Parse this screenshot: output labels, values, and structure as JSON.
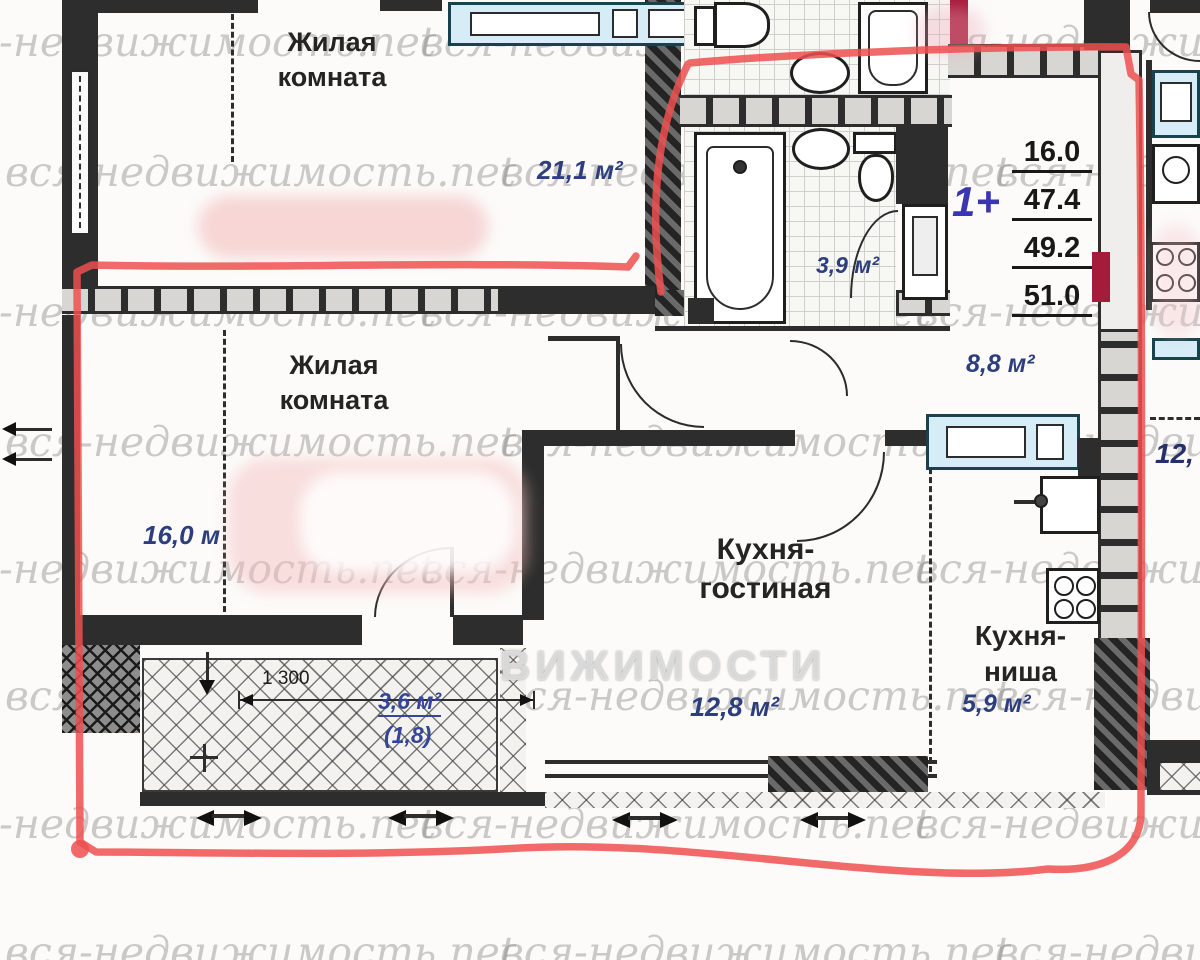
{
  "plan": {
    "watermark_text": "вся-недвижимость.net",
    "watermark_big_partial": "ВИЖИМОСТИ",
    "rooms": {
      "living1": {
        "name": "Жилая комната",
        "area": "21,1 м²"
      },
      "living2": {
        "name": "Жилая комната",
        "area": "16,0 м"
      },
      "bathroom": {
        "area": "3,9 м²"
      },
      "hallway": {
        "area": "8,8 м²"
      },
      "kitchen_living": {
        "name": "Кухня-гостиная",
        "area": "12,8 м²"
      },
      "kitchen_niche": {
        "name": "Кухня-ниша",
        "area": "5,9 м²"
      },
      "balcony": {
        "area": "3,6 м²",
        "area_reduced": "(1,8)"
      },
      "neighbor_partial_area": "12,"
    },
    "summary": {
      "type_label": "1+",
      "areas": [
        "16.0",
        "47.4",
        "49.2",
        "51.0"
      ]
    },
    "dimensions": {
      "balcony_width_mm": "1 300"
    },
    "annotation_color": "#ef5050"
  }
}
